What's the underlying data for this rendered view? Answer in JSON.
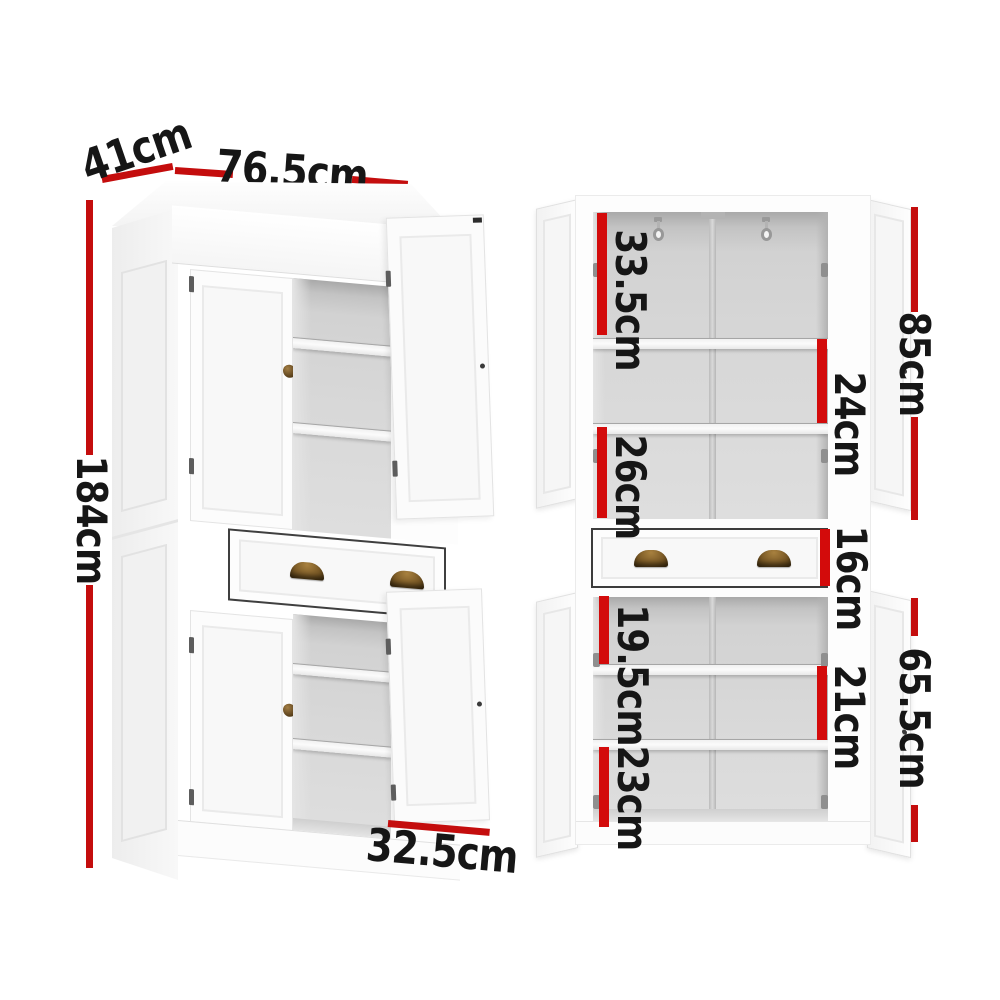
{
  "image_type": "furniture dimension diagram, two views of a white pantry cabinet",
  "colors": {
    "dimension_bar_red": "#d30b0b",
    "dimension_line_red": "#c40d0d",
    "label_text": "#161616",
    "cabinet_white": "#fdfdfd",
    "interior_gray": "#d8d8d8",
    "handle_bronze": "#7b5a26"
  },
  "dims": {
    "height": "184cm",
    "width": "76.5cm",
    "depth": "41cm",
    "bottom_door_width": "32.5cm",
    "upper_section_height": "85cm",
    "lower_section_height": "65.5cm",
    "upper_compartment_1": "33.5cm",
    "upper_compartment_2": "24cm",
    "upper_compartment_3": "26cm",
    "drawer_height": "16cm",
    "lower_compartment_1": "19.5cm",
    "lower_compartment_2": "21cm",
    "lower_compartment_3": "23cm"
  }
}
